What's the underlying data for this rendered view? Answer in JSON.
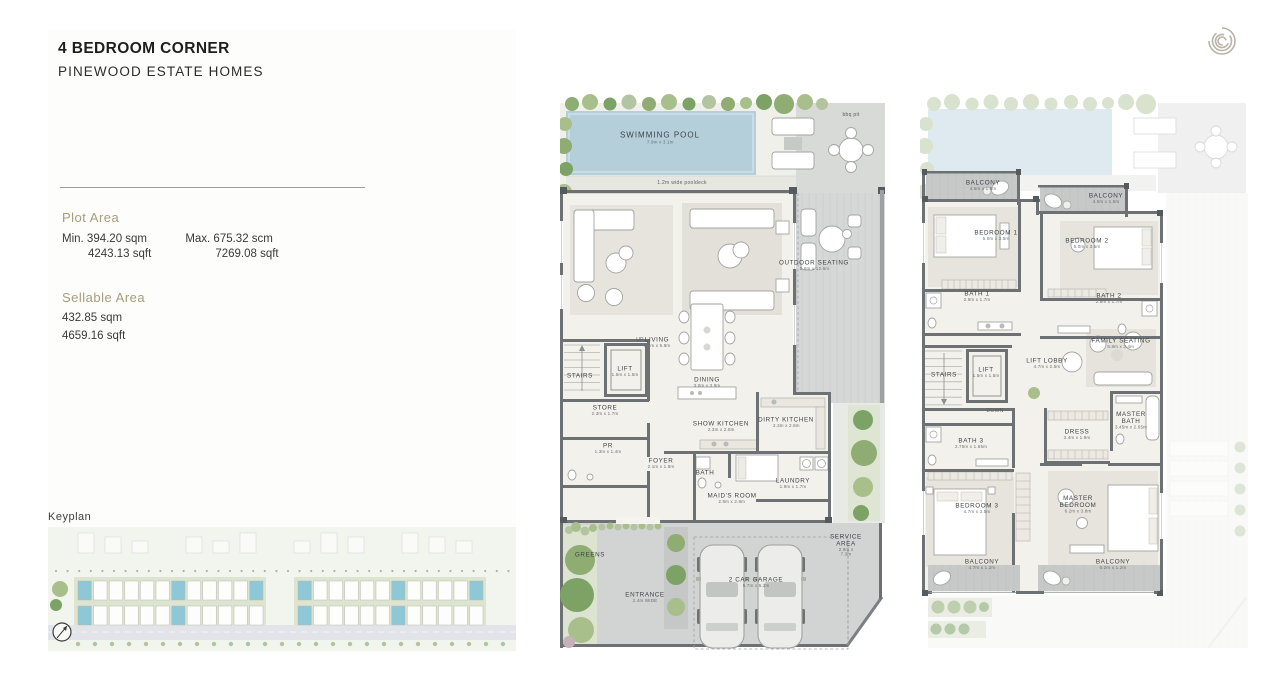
{
  "header": {
    "title": "4 BEDROOM CORNER",
    "subtitle": "PINEWOOD ESTATE HOMES"
  },
  "logo": {
    "icon": "spiral-logo"
  },
  "specs": {
    "plot_area": {
      "heading": "Plot Area",
      "min": {
        "line1": "Min. 394.20 sqm",
        "line2": "4243.13 sqft"
      },
      "max": {
        "line1": "Max. 675.32 scm",
        "line2": "7269.08 sqft"
      }
    },
    "sellable_area": {
      "heading": "Sellable Area",
      "line1": "432.85 sqm",
      "line2": "4659.16 sqft"
    }
  },
  "keyplan": {
    "label": "Keyplan"
  },
  "colors": {
    "accent": "#a79d7b",
    "wall": "#6e7173",
    "pool": "#b4cfda",
    "floor": "#f3f1ec",
    "deck": "#d5d7d6",
    "tree": "#87a768",
    "keyplan_highlight": "#8ec7d6",
    "text": "#2f3133"
  },
  "floorplans": {
    "ground": {
      "name": "ground-floor",
      "rooms": [
        {
          "label": "SWIMMING POOL",
          "dim": "7.9m x 3.1m",
          "x": 100,
          "y": 46,
          "cls": "lg"
        },
        {
          "label": "1.2m wide pooldeck",
          "x": 122,
          "y": 91,
          "cls": "note"
        },
        {
          "label": "bbq pit",
          "x": 291,
          "y": 23,
          "cls": "note"
        },
        {
          "label": "LIVING",
          "dim": "8.5m x 5.8m",
          "x": 97,
          "y": 251
        },
        {
          "label": "OUTDOOR SEATING",
          "dim": "5.6m x 12.6m",
          "x": 254,
          "y": 174
        },
        {
          "label": "UP",
          "x": 80,
          "y": 248,
          "cls": "note"
        },
        {
          "label": "STAIRS",
          "x": 20,
          "y": 283
        },
        {
          "label": "LIFT",
          "dim": "1.5m x 1.5m",
          "x": 65,
          "y": 280
        },
        {
          "label": "DINING",
          "dim": "3.0m x 3.9m",
          "x": 147,
          "y": 291
        },
        {
          "label": "STORE",
          "dim": "2.3m x 1.7m",
          "x": 45,
          "y": 319
        },
        {
          "label": "PR",
          "dim": "1.3m x 1.4m",
          "x": 48,
          "y": 357
        },
        {
          "label": "SHOW KITCHEN",
          "dim": "2.3m x 2.8m",
          "x": 161,
          "y": 335
        },
        {
          "label": "DIRTY KITCHEN",
          "dim": "2.3m x 2.8m",
          "x": 226,
          "y": 331
        },
        {
          "label": "FOYER",
          "dim": "2.1m x 1.8m",
          "x": 101,
          "y": 372
        },
        {
          "label": "BATH",
          "x": 145,
          "y": 380
        },
        {
          "label": "MAID'S ROOM",
          "dim": "2.9m x 2.8m",
          "x": 172,
          "y": 407
        },
        {
          "label": "LAUNDRY",
          "dim": "1.9m x 1.7m",
          "x": 233,
          "y": 392
        },
        {
          "label": "GREENS",
          "x": 30,
          "y": 462
        },
        {
          "label": "ENTRANCE",
          "dim": "2.4m WIDE",
          "x": 85,
          "y": 506
        },
        {
          "label": "2 CAR GARAGE",
          "dim": "5.7m x 5.2m",
          "x": 196,
          "y": 491
        },
        {
          "label": "SERVICE AREA",
          "dim": "2.8m x 7.3m",
          "x": 286,
          "y": 455
        }
      ]
    },
    "first": {
      "name": "first-floor",
      "rooms": [
        {
          "label": "BALCONY",
          "dim": "4.5m x 1.5m",
          "x": 63,
          "y": 94
        },
        {
          "label": "BALCONY",
          "dim": "4.5m x 1.5m",
          "x": 186,
          "y": 107
        },
        {
          "label": "BEDROOM 1",
          "dim": "5.0m x 3.5m",
          "x": 76,
          "y": 144
        },
        {
          "label": "BEDROOM 2",
          "dim": "5.0m x 3.5m",
          "x": 167,
          "y": 152
        },
        {
          "label": "BATH 1",
          "dim": "2.8m x 1.7m",
          "x": 57,
          "y": 205
        },
        {
          "label": "BATH 2",
          "dim": "2.8m x 1.7m",
          "x": 189,
          "y": 207
        },
        {
          "label": "STAIRS",
          "x": 24,
          "y": 282
        },
        {
          "label": "LIFT",
          "dim": "1.5m x 1.5m",
          "x": 66,
          "y": 281
        },
        {
          "label": "DOWN",
          "x": 75,
          "y": 319,
          "cls": "note"
        },
        {
          "label": "LIFT LOBBY",
          "dim": "4.7m x 2.5m",
          "x": 127,
          "y": 272
        },
        {
          "label": "FAMILY SEATING",
          "dim": "5.8m x 3.4m",
          "x": 201,
          "y": 252
        },
        {
          "label": "MASTER\nBATH",
          "dim": "3.45m x 2.65m",
          "x": 211,
          "y": 329
        },
        {
          "label": "DRESS",
          "dim": "3.4m x 1.9m",
          "x": 157,
          "y": 343
        },
        {
          "label": "BATH 3",
          "dim": "2.75m x 1.65m",
          "x": 51,
          "y": 352
        },
        {
          "label": "BEDROOM 3",
          "dim": "4.7m x 3.5m",
          "x": 57,
          "y": 417
        },
        {
          "label": "MASTER\nBEDROOM",
          "dim": "6.2m x 3.8m",
          "x": 158,
          "y": 413
        },
        {
          "label": "BALCONY",
          "dim": "4.7m x 1.2m",
          "x": 62,
          "y": 473
        },
        {
          "label": "BALCONY",
          "dim": "6.2m x 1.2m",
          "x": 193,
          "y": 473
        }
      ]
    }
  }
}
